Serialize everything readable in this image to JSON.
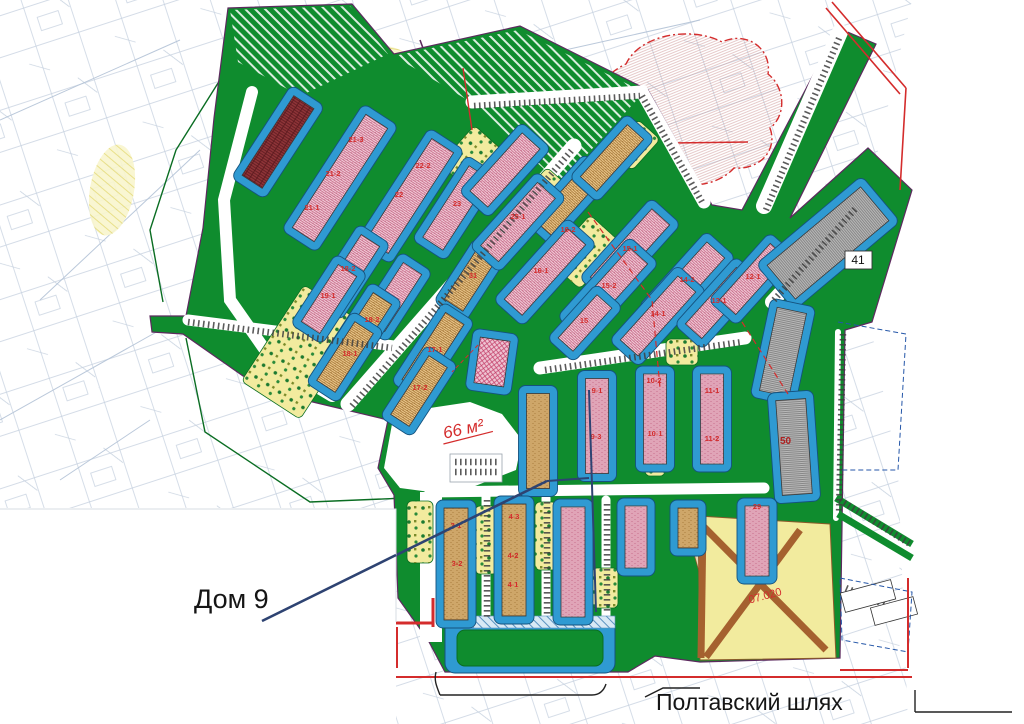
{
  "annotations": {
    "dom9": "Дом 9",
    "street": "Полтавский шлях",
    "badge41": "41",
    "label50": "50",
    "area_note": "66 м²",
    "zone_label": "07.020"
  },
  "colors": {
    "green": "#0f8c2e",
    "yard_blue": "#2f9ad2",
    "yard_blue_border": "#14527e",
    "pink_bg": "#f3cfdb",
    "pink_hatch": "#c05c7c",
    "tan_bg": "#ecc98e",
    "tan_hatch": "#9c6c2c",
    "gray_bg": "#b9b9b9",
    "gray_hatch": "#777777",
    "maroon_bg": "#8e3438",
    "magenta_bg": "#eec3d2",
    "park_yellow": "#f2eb9e",
    "zone_yellow": "#f2eb9e",
    "zone_road_brown": "#a5612f",
    "red": "#d42c2c",
    "navy": "#2e4372",
    "purple": "#5c2a5e",
    "cadastral": "#b6c4d6",
    "building_stroke": "#3a3a3a"
  },
  "map": {
    "buildings": [
      {
        "x": 278,
        "y": 142,
        "len": 95,
        "w": 24,
        "a": 33,
        "p": "maroon"
      },
      {
        "x": 340,
        "y": 178,
        "len": 135,
        "w": 26,
        "a": 33,
        "p": "pink"
      },
      {
        "x": 410,
        "y": 196,
        "len": 120,
        "w": 26,
        "a": 33,
        "p": "pink"
      },
      {
        "x": 456,
        "y": 208,
        "len": 85,
        "w": 24,
        "a": 33,
        "p": "pink"
      },
      {
        "x": 350,
        "y": 272,
        "len": 75,
        "w": 22,
        "a": 33,
        "p": "pink"
      },
      {
        "x": 329,
        "y": 299,
        "len": 68,
        "w": 22,
        "a": 33,
        "p": "pink"
      },
      {
        "x": 394,
        "y": 297,
        "len": 68,
        "w": 22,
        "a": 33,
        "p": "pink"
      },
      {
        "x": 470,
        "y": 280,
        "len": 60,
        "w": 22,
        "a": 33,
        "p": "tan"
      },
      {
        "x": 362,
        "y": 330,
        "len": 75,
        "w": 22,
        "a": 33,
        "p": "tan"
      },
      {
        "x": 345,
        "y": 357,
        "len": 70,
        "w": 22,
        "a": 33,
        "p": "tan"
      },
      {
        "x": 433,
        "y": 352,
        "len": 80,
        "w": 22,
        "a": 33,
        "p": "tan"
      },
      {
        "x": 419,
        "y": 391,
        "len": 70,
        "w": 22,
        "a": 33,
        "p": "tan"
      },
      {
        "x": 568,
        "y": 200,
        "len": 75,
        "w": 22,
        "a": 42,
        "p": "tan"
      },
      {
        "x": 612,
        "y": 158,
        "len": 70,
        "w": 22,
        "a": 42,
        "p": "tan"
      },
      {
        "x": 505,
        "y": 170,
        "len": 78,
        "w": 24,
        "a": 42,
        "p": "pink"
      },
      {
        "x": 518,
        "y": 222,
        "len": 85,
        "w": 24,
        "a": 42,
        "p": "pink"
      },
      {
        "x": 545,
        "y": 272,
        "len": 95,
        "w": 24,
        "a": 42,
        "p": "pink"
      },
      {
        "x": 630,
        "y": 251,
        "len": 92,
        "w": 24,
        "a": 42,
        "p": "pink"
      },
      {
        "x": 608,
        "y": 290,
        "len": 92,
        "w": 24,
        "a": 42,
        "p": "pink"
      },
      {
        "x": 585,
        "y": 323,
        "len": 58,
        "w": 20,
        "a": 42,
        "p": "pink"
      },
      {
        "x": 687,
        "y": 282,
        "len": 86,
        "w": 24,
        "a": 42,
        "p": "pink"
      },
      {
        "x": 658,
        "y": 316,
        "len": 86,
        "w": 24,
        "a": 42,
        "p": "pink"
      },
      {
        "x": 719,
        "y": 303,
        "len": 76,
        "w": 22,
        "a": 42,
        "p": "pink"
      },
      {
        "x": 753,
        "y": 279,
        "len": 76,
        "w": 22,
        "a": 42,
        "p": "pink"
      },
      {
        "x": 538,
        "y": 441,
        "len": 95,
        "w": 23,
        "a": 0,
        "p": "tan"
      },
      {
        "x": 597,
        "y": 426,
        "len": 95,
        "w": 23,
        "a": 0,
        "p": "pink"
      },
      {
        "x": 655,
        "y": 419,
        "len": 90,
        "w": 23,
        "a": 0,
        "p": "pink"
      },
      {
        "x": 712,
        "y": 419,
        "len": 90,
        "w": 23,
        "a": 0,
        "p": "pink"
      },
      {
        "x": 492,
        "y": 362,
        "len": 46,
        "w": 30,
        "a": 8,
        "p": "magenta"
      },
      {
        "x": 456,
        "y": 564,
        "len": 112,
        "w": 24,
        "a": 0,
        "p": "tan"
      },
      {
        "x": 514,
        "y": 560,
        "len": 112,
        "w": 24,
        "a": 0,
        "p": "tan"
      },
      {
        "x": 573,
        "y": 562,
        "len": 110,
        "w": 24,
        "a": 0,
        "p": "pink"
      },
      {
        "x": 636,
        "y": 537,
        "len": 62,
        "w": 22,
        "a": 0,
        "p": "pink"
      },
      {
        "x": 688,
        "y": 528,
        "len": 40,
        "w": 20,
        "a": 0,
        "p": "tan"
      },
      {
        "x": 757,
        "y": 541,
        "len": 70,
        "w": 24,
        "a": 0,
        "p": "pink"
      },
      {
        "x": 828,
        "y": 243,
        "len": 122,
        "w": 44,
        "a": 50,
        "p": "gray"
      },
      {
        "x": 783,
        "y": 352,
        "len": 85,
        "w": 30,
        "a": 12,
        "p": "gray"
      },
      {
        "x": 794,
        "y": 447,
        "len": 95,
        "w": 30,
        "a": -4,
        "p": "gray"
      }
    ],
    "numbers": [
      {
        "t": "21-3",
        "x": 356,
        "y": 142
      },
      {
        "t": "21-2",
        "x": 333,
        "y": 176
      },
      {
        "t": "21-1",
        "x": 312,
        "y": 210
      },
      {
        "t": "22-2",
        "x": 423,
        "y": 168
      },
      {
        "t": "22",
        "x": 399,
        "y": 197
      },
      {
        "t": "23",
        "x": 457,
        "y": 206
      },
      {
        "t": "18-2",
        "x": 348,
        "y": 271
      },
      {
        "t": "19-1",
        "x": 328,
        "y": 298
      },
      {
        "t": "31",
        "x": 473,
        "y": 278
      },
      {
        "t": "18-2",
        "x": 372,
        "y": 322
      },
      {
        "t": "18-1",
        "x": 350,
        "y": 356
      },
      {
        "t": "17-1",
        "x": 435,
        "y": 352
      },
      {
        "t": "17-2",
        "x": 420,
        "y": 390
      },
      {
        "t": "25-1",
        "x": 518,
        "y": 219
      },
      {
        "t": "16-2",
        "x": 568,
        "y": 232
      },
      {
        "t": "16-1",
        "x": 541,
        "y": 273
      },
      {
        "t": "15-1",
        "x": 630,
        "y": 251
      },
      {
        "t": "15-2",
        "x": 609,
        "y": 288
      },
      {
        "t": "15",
        "x": 584,
        "y": 323
      },
      {
        "t": "14-2",
        "x": 687,
        "y": 282
      },
      {
        "t": "14-1",
        "x": 658,
        "y": 316
      },
      {
        "t": "13-1",
        "x": 719,
        "y": 303
      },
      {
        "t": "12-1",
        "x": 753,
        "y": 279
      },
      {
        "t": "9-1",
        "x": 597,
        "y": 393
      },
      {
        "t": "9-3",
        "x": 596,
        "y": 439
      },
      {
        "t": "10-2",
        "x": 654,
        "y": 383
      },
      {
        "t": "10-1",
        "x": 655,
        "y": 436
      },
      {
        "t": "11-1",
        "x": 712,
        "y": 393
      },
      {
        "t": "11-2",
        "x": 712,
        "y": 441
      },
      {
        "t": "3-1",
        "x": 456,
        "y": 528
      },
      {
        "t": "3-2",
        "x": 457,
        "y": 566
      },
      {
        "t": "4-3",
        "x": 514,
        "y": 519
      },
      {
        "t": "4-2",
        "x": 513,
        "y": 558
      },
      {
        "t": "4-1",
        "x": 513,
        "y": 587
      },
      {
        "t": "29",
        "x": 757,
        "y": 509
      }
    ],
    "parks": [
      {
        "x": 302,
        "y": 352,
        "w": 70,
        "h": 115,
        "a": 33
      },
      {
        "x": 585,
        "y": 252,
        "w": 42,
        "h": 62,
        "a": 42
      },
      {
        "x": 472,
        "y": 158,
        "w": 40,
        "h": 52,
        "a": 42
      },
      {
        "x": 545,
        "y": 195,
        "w": 34,
        "h": 44,
        "a": 42
      },
      {
        "x": 635,
        "y": 145,
        "w": 30,
        "h": 42,
        "a": 42
      },
      {
        "x": 682,
        "y": 352,
        "w": 32,
        "h": 26,
        "a": 0
      },
      {
        "x": 486,
        "y": 540,
        "w": 22,
        "h": 68,
        "a": 0
      },
      {
        "x": 546,
        "y": 536,
        "w": 22,
        "h": 68,
        "a": 0
      },
      {
        "x": 605,
        "y": 588,
        "w": 26,
        "h": 40,
        "a": 0
      },
      {
        "x": 420,
        "y": 532,
        "w": 26,
        "h": 62,
        "a": 0
      },
      {
        "x": 655,
        "y": 462,
        "w": 20,
        "h": 28,
        "a": 0
      }
    ],
    "ticks": [
      [
        188,
        322,
        392,
        348
      ],
      [
        352,
        406,
        572,
        150
      ],
      [
        474,
        106,
        640,
        96
      ],
      [
        642,
        96,
        702,
        202
      ],
      [
        545,
        370,
        742,
        342
      ],
      [
        766,
        210,
        840,
        36
      ],
      [
        774,
        300,
        856,
        208
      ],
      [
        840,
        500,
        910,
        544
      ],
      [
        843,
        334,
        839,
        514
      ],
      [
        487,
        500,
        487,
        620
      ],
      [
        547,
        502,
        547,
        616
      ],
      [
        607,
        504,
        607,
        614
      ],
      [
        455,
        462,
        498,
        462
      ],
      [
        455,
        472,
        498,
        472
      ],
      [
        846,
        588,
        902,
        612
      ]
    ]
  }
}
